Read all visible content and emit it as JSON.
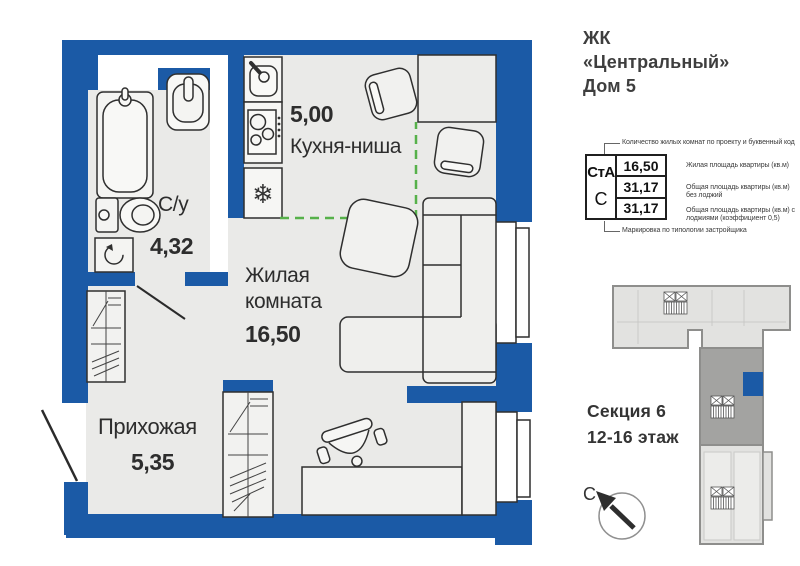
{
  "header": {
    "line1": "ЖК",
    "line2": "«Центральный»",
    "line3": "Дом 5"
  },
  "plan": {
    "rooms": {
      "kitchen": {
        "area": "5,00",
        "name": "Кухня-ниша"
      },
      "bathroom": {
        "name": "С/у",
        "area": "4,32"
      },
      "living": {
        "name": "Жилая комната",
        "area": "16,50"
      },
      "hallway": {
        "name": "Прихожая",
        "area": "5,35"
      }
    },
    "icons": {
      "fridge_snowflake": "❄"
    }
  },
  "info_table": {
    "top_note": "Количество жилых комнат по проекту и буквенный код",
    "code": "СтА",
    "type_letter": "С",
    "rows": [
      {
        "value": "16,50",
        "note": "Жилая площадь квартиры (кв.м)"
      },
      {
        "value": "31,17",
        "note": "Общая площадь квартиры (кв.м) без лоджий"
      },
      {
        "value": "31,17",
        "note": "Общая площадь квартиры (кв.м) с лоджиями (коэффициент 0,5)"
      }
    ],
    "bottom_note": "Маркировка по типологии застройщика"
  },
  "section_block": {
    "line1": "Секция 6",
    "line2": "12-16 этаж"
  },
  "compass": {
    "north_letter": "С"
  },
  "colors": {
    "wall_blue": "#1b5aa6",
    "floor_gray": "#eaeae8",
    "outline_dark": "#2f2f2f",
    "kitchen_zone_dash_green": "#56b14a",
    "footprint_light": "#e2e2e0",
    "footprint_dark": "#a3a3a1",
    "footprint_stroke": "#8e8e8c",
    "text_dark": "#2d2d2d"
  }
}
